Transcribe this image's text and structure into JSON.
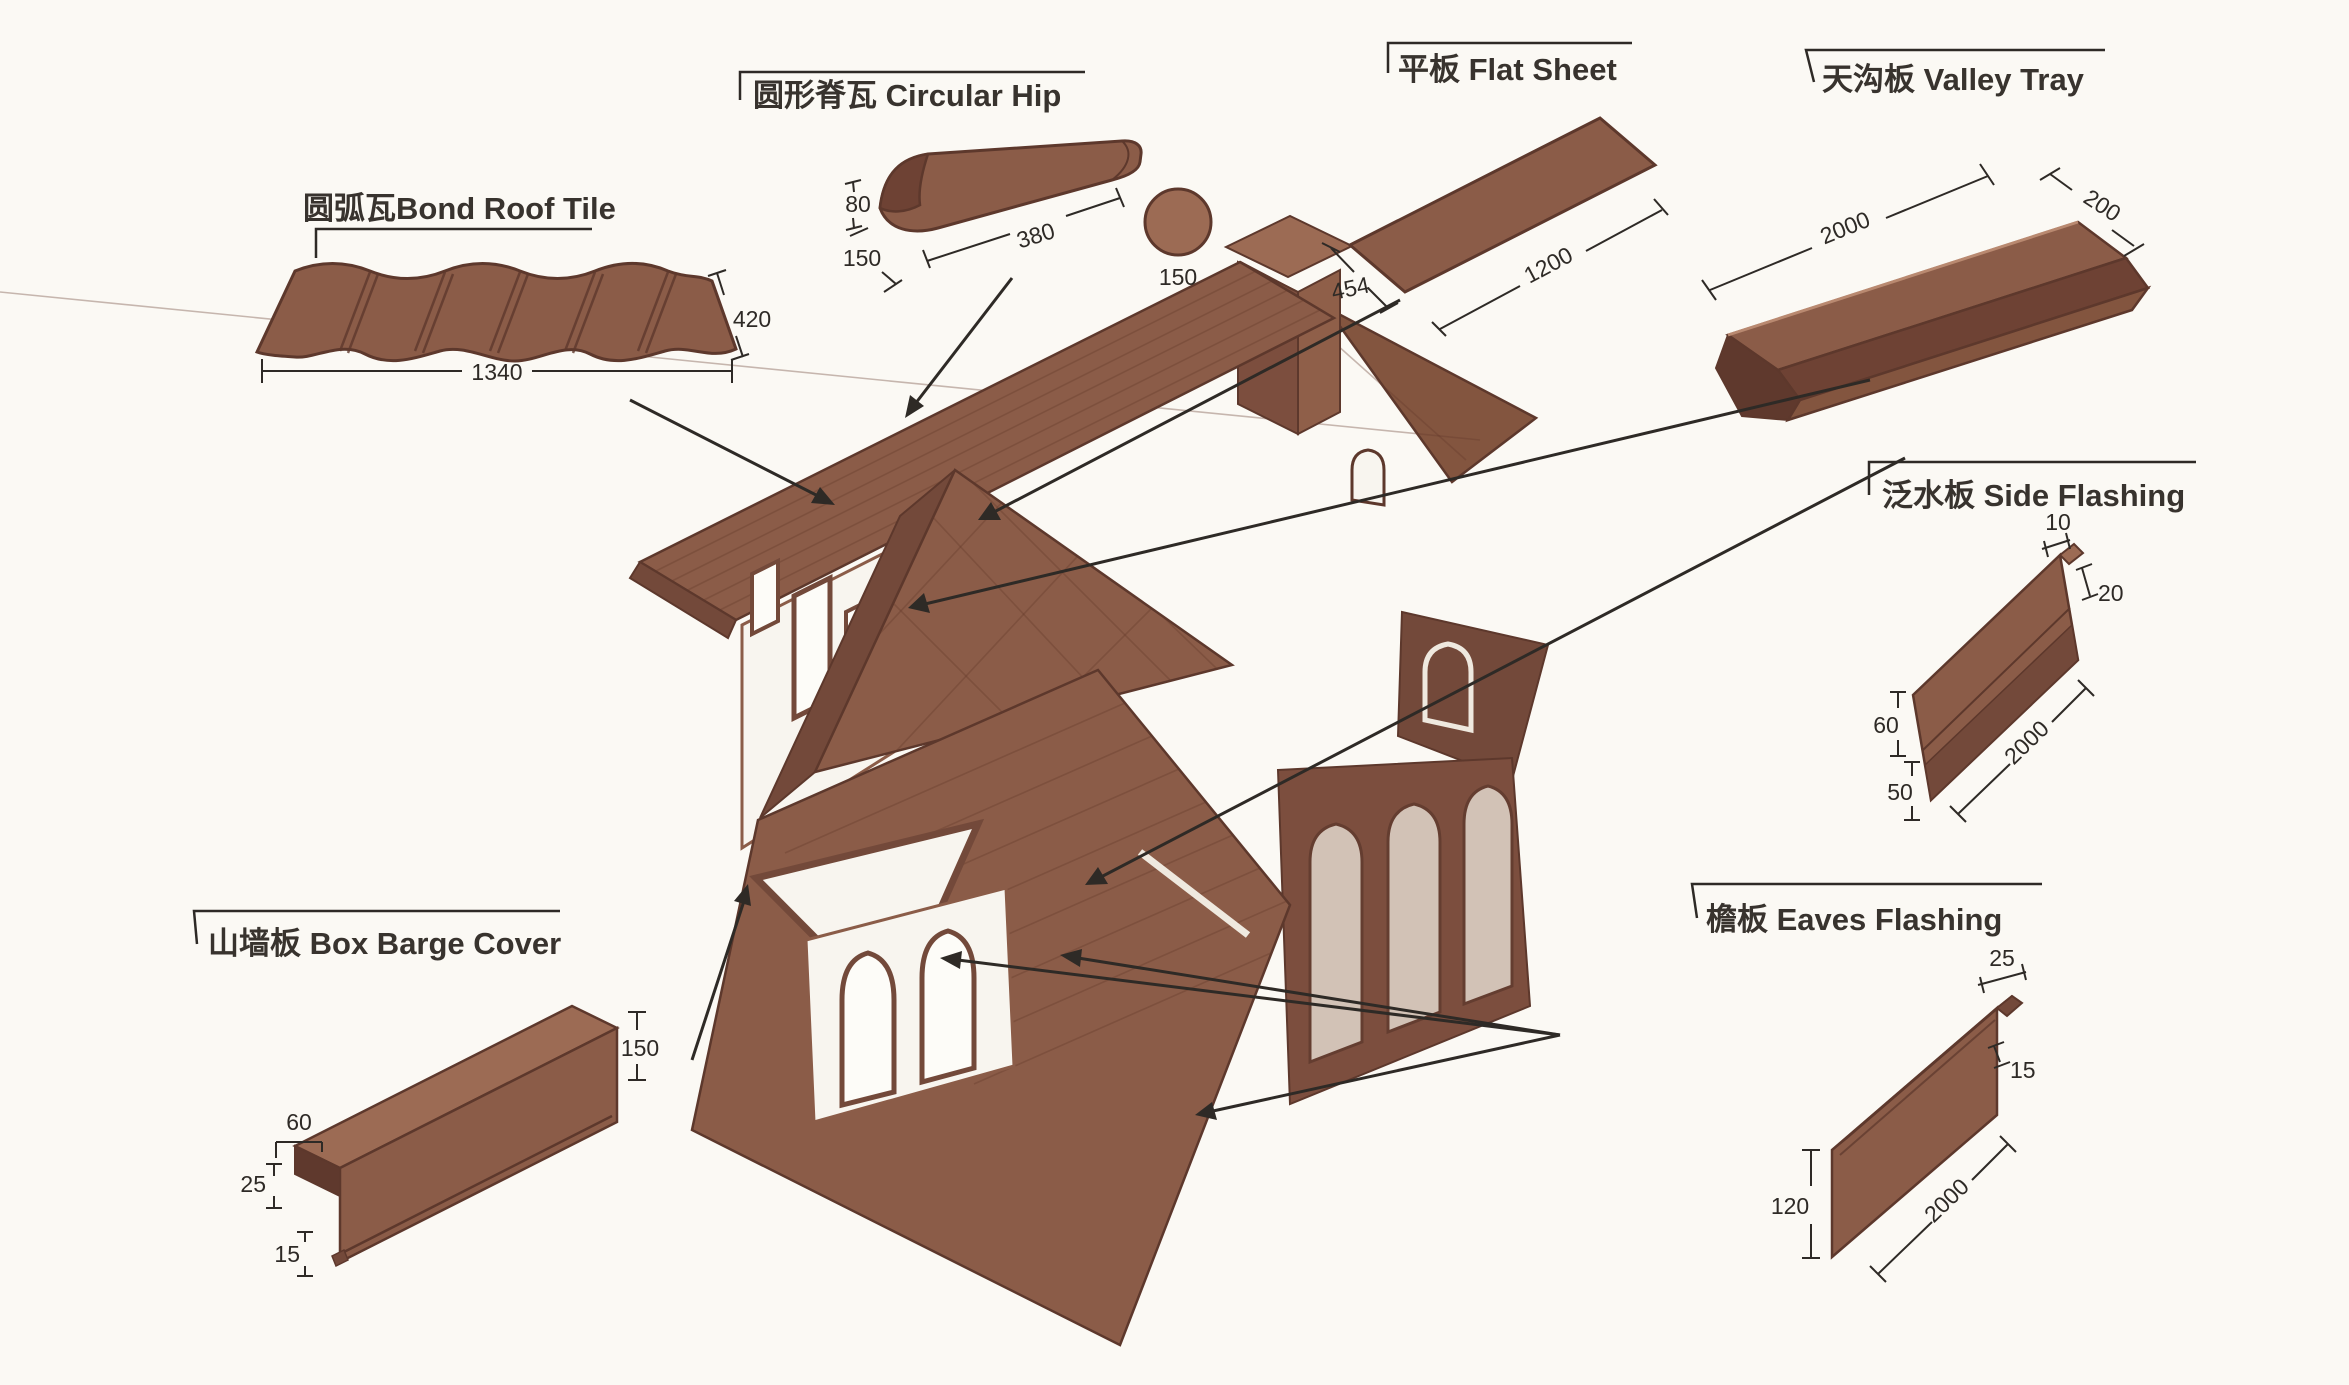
{
  "figure": {
    "type": "roof-tile-accessories-diagram",
    "background": "#fbf9f4",
    "ink_color": "#2e2a26",
    "tile_brown": "#8b5c48",
    "tile_brown_dark": "#73493a",
    "tile_brown_darker": "#5f392d",
    "tile_brown_light": "#a06f58",
    "wall_white": "#f8f5ef"
  },
  "components": {
    "bond_roof_tile": {
      "label_zh": "圆弧瓦",
      "label_en": "Bond Roof Tile",
      "dim_height": "420",
      "dim_width": "1340"
    },
    "circular_hip": {
      "label_zh": "圆形脊瓦 ",
      "label_en": "Circular Hip",
      "dim_height": "80",
      "dim_edge": "150",
      "dim_length": "380",
      "dim_diameter": "150"
    },
    "flat_sheet": {
      "label_zh": "平板 ",
      "label_en": "Flat Sheet",
      "dim_width": "454",
      "dim_length": "1200"
    },
    "valley_tray": {
      "label_zh": "天沟板 ",
      "label_en": "Valley Tray",
      "dim_length": "2000",
      "dim_width": "200"
    },
    "side_flashing": {
      "label_zh": "泛水板 ",
      "label_en": "Side Flashing",
      "dim_top": "10",
      "dim_step": "20",
      "dim_upper": "60",
      "dim_length": "2000",
      "dim_lower": "50"
    },
    "eaves_flashing": {
      "label_zh": "檐板 ",
      "label_en": "Eaves Flashing",
      "dim_top": "25",
      "dim_lip": "15",
      "dim_length": "2000",
      "dim_height": "120"
    },
    "box_barge_cover": {
      "label_zh": "山墙板 ",
      "label_en": "Box Barge Cover",
      "dim_end": "150",
      "dim_top": "60",
      "dim_left": "25",
      "dim_lip": "15"
    }
  }
}
